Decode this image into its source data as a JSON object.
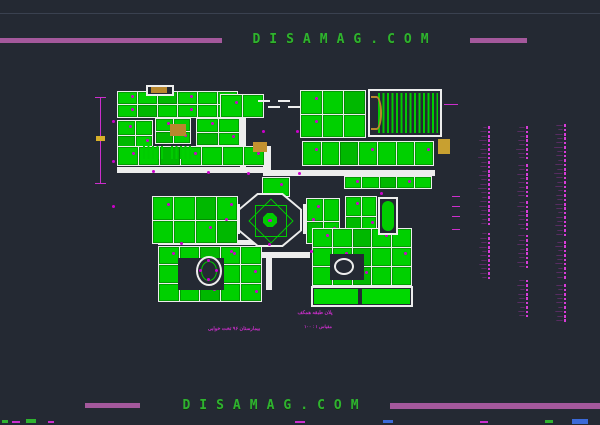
{
  "brand": {
    "top_text": "DISAMAG.COM",
    "bottom_text": "DISAMAG.COM"
  },
  "colors": {
    "background": "#242933",
    "drawing_green": "#00d000",
    "wall_white": "#ededed",
    "annotation_magenta": "#cc2ecc",
    "watermark_bar_purple": "#a4589c",
    "watermark_text_green": "#2fb32f",
    "accent_tan": "#b8872e",
    "dimension_label_yellow": "#d8b02a"
  },
  "captions": {
    "plan_title": "پلان طبقه همکف",
    "scale_note": "مقیاس ۱ : ۱۰۰",
    "project_title": "بیمارستان ۹۶ تخت خوابی"
  },
  "legend": {
    "columns": [
      {
        "x": 460,
        "y": 126,
        "w": 30,
        "groups": [
          {
            "gap": 0,
            "rows": [
              3,
              6,
              5,
              7,
              4,
              6,
              5,
              8,
              5,
              6,
              4,
              7,
              5,
              6,
              8,
              5,
              4,
              6,
              7,
              5,
              6,
              4,
              5
            ]
          },
          {
            "gap": 6,
            "rows": [
              4,
              6,
              5,
              7,
              4,
              6,
              5,
              7,
              5,
              6,
              4
            ]
          }
        ]
      },
      {
        "x": 498,
        "y": 126,
        "w": 30,
        "groups": [
          {
            "gap": 0,
            "rows": [
              5,
              7,
              4,
              6,
              5,
              8,
              6,
              5
            ]
          },
          {
            "gap": 3,
            "rows": [
              6,
              5,
              7,
              4,
              6,
              5,
              7,
              6
            ]
          },
          {
            "gap": 2,
            "rows": [
              5,
              7,
              4,
              6,
              5,
              6,
              4
            ]
          },
          {
            "gap": 3,
            "rows": [
              6,
              5,
              7,
              4,
              6,
              5,
              7,
              5
            ]
          },
          {
            "gap": 10,
            "rows": [
              5,
              7,
              4,
              6,
              5,
              7,
              4,
              6,
              5
            ]
          }
        ]
      },
      {
        "x": 536,
        "y": 124,
        "w": 30,
        "groups": [
          {
            "gap": 0,
            "rows": [
              6,
              4,
              7,
              5,
              6,
              8,
              5,
              6,
              4,
              7,
              5,
              8,
              6,
              5,
              7,
              4,
              6,
              5,
              7,
              6,
              4,
              6,
              5,
              7,
              5,
              6
            ]
          },
          {
            "gap": 3,
            "rows": [
              5,
              7,
              4,
              6,
              5,
              7,
              4,
              6,
              5
            ]
          },
          {
            "gap": 4,
            "rows": [
              6,
              4,
              7,
              5,
              6,
              4,
              7,
              5,
              6
            ]
          }
        ]
      }
    ]
  },
  "plan": {
    "elements": [
      {
        "t": "bar",
        "x": 100,
        "y": 97,
        "w": 1,
        "h": 86,
        "c": "#cc2ecc"
      },
      {
        "t": "bar",
        "x": 95,
        "y": 97,
        "w": 11,
        "h": 1,
        "c": "#cc2ecc"
      },
      {
        "t": "bar",
        "x": 95,
        "y": 183,
        "w": 11,
        "h": 1,
        "c": "#cc2ecc"
      },
      {
        "t": "bar",
        "x": 96,
        "y": 136,
        "w": 9,
        "h": 5,
        "c": "#d8b02a"
      },
      {
        "t": "bar",
        "x": 117,
        "y": 167,
        "w": 150,
        "h": 6,
        "c": "#ededed"
      },
      {
        "t": "bar",
        "x": 265,
        "y": 170,
        "w": 170,
        "h": 6,
        "c": "#ededed"
      },
      {
        "t": "bar",
        "x": 240,
        "y": 96,
        "w": 6,
        "h": 72,
        "c": "#ededed"
      },
      {
        "t": "bar",
        "x": 263,
        "y": 146,
        "w": 8,
        "h": 30,
        "c": "#ededed"
      },
      {
        "t": "bar",
        "x": 232,
        "y": 204,
        "w": 8,
        "h": 30,
        "c": "#ededed"
      },
      {
        "t": "bar",
        "x": 303,
        "y": 204,
        "w": 8,
        "h": 30,
        "c": "#ededed"
      },
      {
        "t": "bar",
        "x": 236,
        "y": 252,
        "w": 74,
        "h": 6,
        "c": "#ededed"
      },
      {
        "t": "bar",
        "x": 158,
        "y": 240,
        "w": 104,
        "h": 5,
        "c": "#ededed"
      },
      {
        "t": "bar",
        "x": 266,
        "y": 256,
        "w": 6,
        "h": 34,
        "c": "#ededed"
      },
      {
        "t": "cluster",
        "x": 117,
        "y": 91,
        "w": 121,
        "h": 27,
        "cols": 6,
        "rows": 2
      },
      {
        "t": "cluster",
        "x": 117,
        "y": 120,
        "w": 36,
        "h": 45,
        "cols": 2,
        "rows": 3
      },
      {
        "t": "cluster",
        "x": 155,
        "y": 118,
        "w": 36,
        "h": 26,
        "cols": 2,
        "rows": 2
      },
      {
        "t": "cluster",
        "x": 196,
        "y": 118,
        "w": 44,
        "h": 28,
        "cols": 2,
        "rows": 2
      },
      {
        "t": "cluster",
        "x": 220,
        "y": 94,
        "w": 44,
        "h": 24,
        "cols": 2,
        "rows": 1
      },
      {
        "t": "cluster",
        "x": 117,
        "y": 146,
        "w": 148,
        "h": 20,
        "cols": 7,
        "rows": 1
      },
      {
        "t": "cluster",
        "x": 300,
        "y": 90,
        "w": 66,
        "h": 48,
        "cols": 3,
        "rows": 2
      },
      {
        "t": "cluster",
        "x": 302,
        "y": 141,
        "w": 132,
        "h": 25,
        "cols": 7,
        "rows": 1
      },
      {
        "t": "cluster",
        "x": 152,
        "y": 196,
        "w": 86,
        "h": 48,
        "cols": 4,
        "rows": 2
      },
      {
        "t": "cluster",
        "x": 344,
        "y": 176,
        "w": 88,
        "h": 13,
        "cols": 5,
        "rows": 1
      },
      {
        "t": "cluster",
        "x": 345,
        "y": 196,
        "w": 32,
        "h": 40,
        "cols": 2,
        "rows": 2
      },
      {
        "t": "cluster",
        "x": 306,
        "y": 198,
        "w": 34,
        "h": 46,
        "cols": 2,
        "rows": 2
      },
      {
        "t": "cluster",
        "x": 158,
        "y": 246,
        "w": 104,
        "h": 56,
        "cols": 5,
        "rows": 3
      },
      {
        "t": "cluster",
        "x": 312,
        "y": 228,
        "w": 100,
        "h": 58,
        "cols": 5,
        "rows": 3
      },
      {
        "t": "cluster",
        "x": 262,
        "y": 177,
        "w": 28,
        "h": 20,
        "cols": 1,
        "rows": 1
      },
      {
        "t": "bar",
        "x": 178,
        "y": 258,
        "w": 46,
        "h": 32,
        "c": "#242933"
      },
      {
        "t": "bar",
        "x": 330,
        "y": 254,
        "w": 34,
        "h": 26,
        "c": "#242933"
      },
      {
        "t": "hatchV",
        "x": 143,
        "y": 146,
        "w": 22,
        "h": 13
      },
      {
        "t": "hatchV",
        "x": 171,
        "y": 146,
        "w": 20,
        "h": 13
      },
      {
        "t": "outline",
        "x": 146,
        "y": 85,
        "w": 28,
        "h": 11
      },
      {
        "t": "outline",
        "x": 368,
        "y": 89,
        "w": 74,
        "h": 48
      },
      {
        "t": "hatchV",
        "x": 378,
        "y": 93,
        "w": 60,
        "h": 40
      },
      {
        "t": "arc",
        "x": 371,
        "y": 96,
        "w": 11,
        "h": 34
      },
      {
        "t": "outline",
        "x": 311,
        "y": 286,
        "w": 102,
        "h": 21
      },
      {
        "t": "bar",
        "x": 314,
        "y": 289,
        "w": 44,
        "h": 15,
        "c": "#00d800"
      },
      {
        "t": "bar",
        "x": 362,
        "y": 289,
        "w": 48,
        "h": 15,
        "c": "#00d800"
      },
      {
        "t": "outline",
        "x": 378,
        "y": 197,
        "w": 20,
        "h": 38
      },
      {
        "t": "bar",
        "x": 382,
        "y": 201,
        "w": 12,
        "h": 30,
        "c": "#00cc00",
        "r": 6
      },
      {
        "t": "bar",
        "x": 151,
        "y": 87,
        "w": 16,
        "h": 6,
        "c": "#b8872e"
      },
      {
        "t": "bar",
        "x": 170,
        "y": 124,
        "w": 16,
        "h": 12,
        "c": "#b8872e"
      },
      {
        "t": "bar",
        "x": 253,
        "y": 142,
        "w": 14,
        "h": 10,
        "c": "#c29130"
      },
      {
        "t": "bar",
        "x": 438,
        "y": 139,
        "w": 12,
        "h": 15,
        "c": "#c8a030"
      },
      {
        "t": "ellipseO",
        "x": 196,
        "y": 256,
        "w": 26,
        "h": 30,
        "inner": "ward"
      },
      {
        "t": "ellipseO",
        "x": 334,
        "y": 258,
        "w": 20,
        "h": 17
      },
      {
        "t": "oct",
        "x": 238,
        "y": 193,
        "w": 64,
        "h": 54
      },
      {
        "t": "bar",
        "x": 258,
        "y": 100,
        "w": 12,
        "h": 2,
        "c": "#ededed"
      },
      {
        "t": "bar",
        "x": 268,
        "y": 106,
        "w": 12,
        "h": 2,
        "c": "#ededed"
      },
      {
        "t": "bar",
        "x": 278,
        "y": 100,
        "w": 12,
        "h": 2,
        "c": "#ededed"
      },
      {
        "t": "bar",
        "x": 288,
        "y": 106,
        "w": 12,
        "h": 2,
        "c": "#ededed"
      },
      {
        "t": "bar",
        "x": 444,
        "y": 104,
        "w": 14,
        "h": 1,
        "c": "#cc2ecc"
      },
      {
        "t": "bar",
        "x": 452,
        "y": 196,
        "w": 8,
        "h": 1,
        "c": "#cc2ecc"
      },
      {
        "t": "bar",
        "x": 452,
        "y": 206,
        "w": 8,
        "h": 1,
        "c": "#cc2ecc"
      },
      {
        "t": "bar",
        "x": 452,
        "y": 216,
        "w": 8,
        "h": 1,
        "c": "#cc2ecc"
      },
      {
        "t": "bar",
        "x": 452,
        "y": 229,
        "w": 8,
        "h": 1,
        "c": "#cc2ecc"
      },
      {
        "t": "dot",
        "x": 268,
        "y": 219
      },
      {
        "t": "dot",
        "x": 247,
        "y": 172
      },
      {
        "t": "dot",
        "x": 298,
        "y": 172
      },
      {
        "t": "dot",
        "x": 268,
        "y": 243
      },
      {
        "t": "dot",
        "x": 207,
        "y": 171
      },
      {
        "t": "dot",
        "x": 152,
        "y": 170
      },
      {
        "t": "dot",
        "x": 230,
        "y": 250
      },
      {
        "t": "dot",
        "x": 310,
        "y": 250
      },
      {
        "t": "dot",
        "x": 380,
        "y": 192
      },
      {
        "t": "dot",
        "x": 262,
        "y": 130
      },
      {
        "t": "dot",
        "x": 296,
        "y": 130
      },
      {
        "t": "dot",
        "x": 225,
        "y": 218
      },
      {
        "t": "dot",
        "x": 312,
        "y": 218
      },
      {
        "t": "dot",
        "x": 180,
        "y": 242
      },
      {
        "t": "dot",
        "x": 255,
        "y": 290
      },
      {
        "t": "dot",
        "x": 112,
        "y": 120
      },
      {
        "t": "dot",
        "x": 112,
        "y": 160
      },
      {
        "t": "dot",
        "x": 112,
        "y": 205
      }
    ]
  },
  "artifacts": [
    {
      "x": 2,
      "y": 420,
      "w": 6,
      "h": 3,
      "c": "#2fb32f"
    },
    {
      "x": 12,
      "y": 421,
      "w": 8,
      "h": 2,
      "c": "#cc2ecc"
    },
    {
      "x": 26,
      "y": 419,
      "w": 10,
      "h": 4,
      "c": "#2fb32f"
    },
    {
      "x": 48,
      "y": 421,
      "w": 6,
      "h": 2,
      "c": "#cc2ecc"
    },
    {
      "x": 295,
      "y": 421,
      "w": 10,
      "h": 2,
      "c": "#cc2ecc"
    },
    {
      "x": 383,
      "y": 420,
      "w": 10,
      "h": 3,
      "c": "#3b6ad8"
    },
    {
      "x": 480,
      "y": 421,
      "w": 8,
      "h": 2,
      "c": "#cc2ecc"
    },
    {
      "x": 545,
      "y": 420,
      "w": 8,
      "h": 3,
      "c": "#2fb32f"
    },
    {
      "x": 572,
      "y": 419,
      "w": 16,
      "h": 5,
      "c": "#3b6ad8"
    }
  ]
}
